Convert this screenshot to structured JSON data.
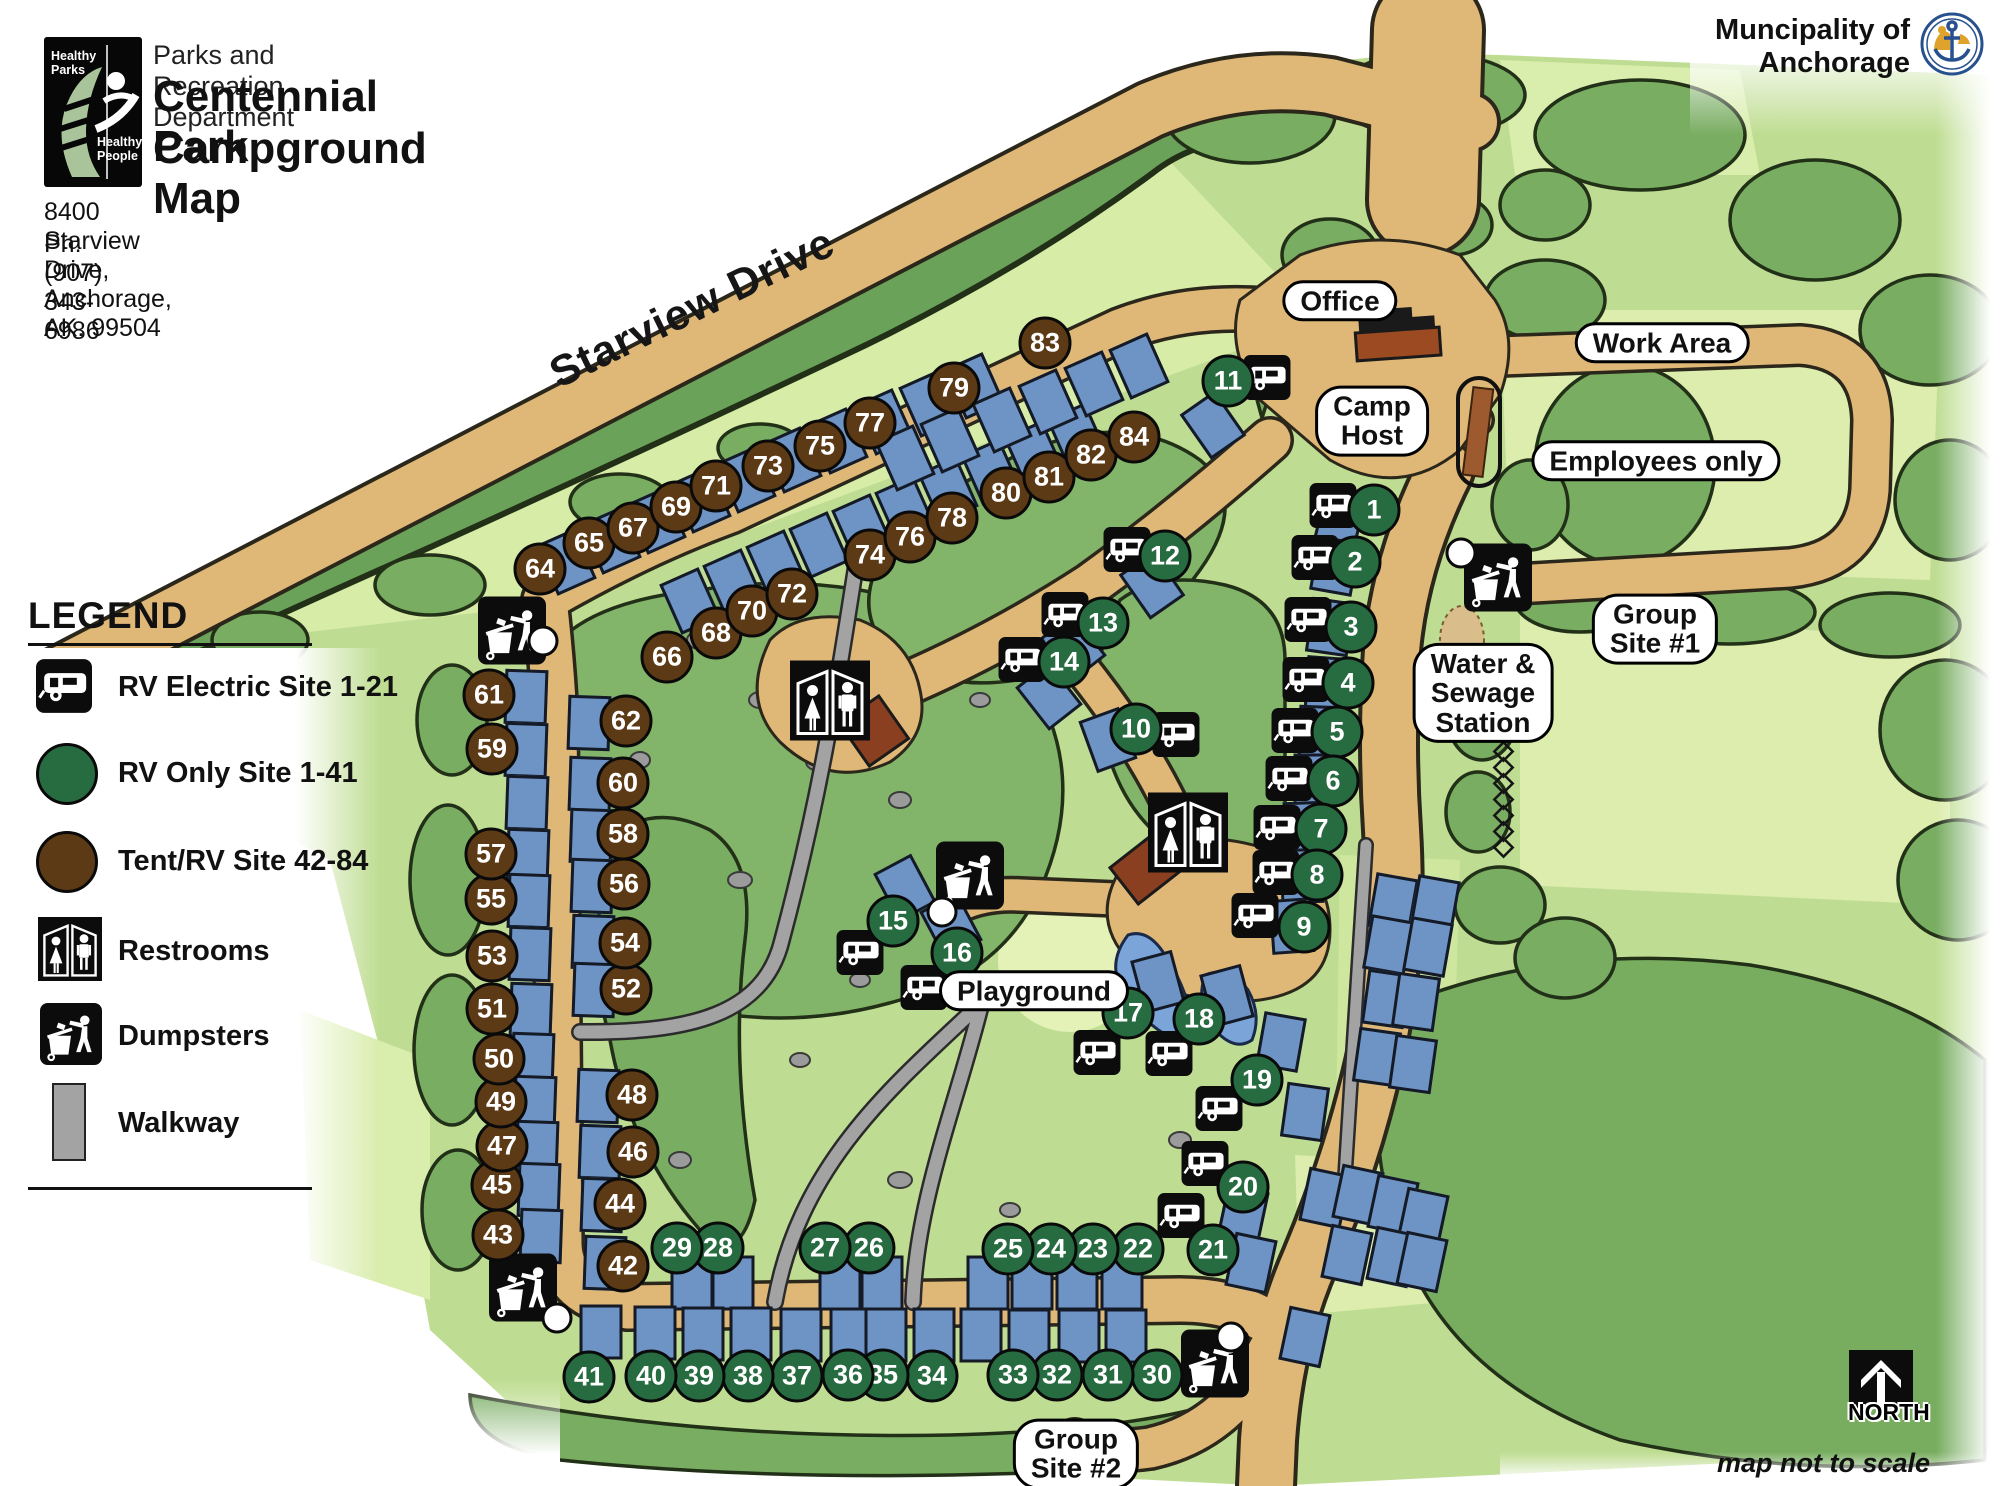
{
  "header": {
    "department": "Parks and Recreation Department",
    "title_line1": "Centennial Park",
    "title_line2": "Campground Map",
    "address": "8400 Starview Drive, Anchorage, AK. 99504",
    "phone": "Ph: (907) 343-6986",
    "logo": {
      "top_text": "Healthy\nParks",
      "bottom_text": "Healthy\nPeople"
    }
  },
  "municipality": {
    "line1": "Muncipality of",
    "line2": "Anchorage"
  },
  "legend": {
    "title": "LEGEND",
    "items": [
      {
        "icon": "rv-electric-icon",
        "label": "RV Electric Site 1-21"
      },
      {
        "icon": "rv-only-circle",
        "label": "RV Only Site 1-41",
        "color": "#276b41"
      },
      {
        "icon": "tent-rv-circle",
        "label": "Tent/RV Site 42-84",
        "color": "#5d3a16"
      },
      {
        "icon": "restrooms-icon",
        "label": "Restrooms"
      },
      {
        "icon": "dumpsters-icon",
        "label": "Dumpsters"
      },
      {
        "icon": "walkway-swatch",
        "label": "Walkway",
        "color": "#a3a3a3"
      }
    ]
  },
  "map": {
    "road_label": "Starview Drive",
    "north_label": "NORTH",
    "scale_note": "map not to scale",
    "colors": {
      "road": "#dfb878",
      "walkway": "#a3a3a3",
      "pad": "#6e93c5",
      "site_rv_only": "#276b41",
      "site_tent_rv": "#5d3a16",
      "tree": "#79ad62",
      "lawn": "#bfdd92"
    },
    "labels": [
      {
        "id": "office",
        "lines": [
          "Office"
        ],
        "x": 1340,
        "y": 301
      },
      {
        "id": "work-area",
        "lines": [
          "Work Area"
        ],
        "x": 1662,
        "y": 343
      },
      {
        "id": "camp-host",
        "lines": [
          "Camp",
          "Host"
        ],
        "x": 1372,
        "y": 421
      },
      {
        "id": "employees-only",
        "lines": [
          "Employees only"
        ],
        "x": 1656,
        "y": 461
      },
      {
        "id": "group-site-1",
        "lines": [
          "Group",
          "Site #1"
        ],
        "x": 1655,
        "y": 629
      },
      {
        "id": "water-sewage-station",
        "lines": [
          "Water &",
          "Sewage",
          "Station"
        ],
        "x": 1483,
        "y": 693
      },
      {
        "id": "playground",
        "lines": [
          "Playground"
        ],
        "x": 1034,
        "y": 991
      },
      {
        "id": "group-site-2",
        "lines": [
          "Group",
          "Site #2"
        ],
        "x": 1076,
        "y": 1454
      }
    ],
    "sites": [
      {
        "n": 1,
        "x": 1374,
        "y": 510
      },
      {
        "n": 2,
        "x": 1355,
        "y": 562
      },
      {
        "n": 3,
        "x": 1351,
        "y": 627
      },
      {
        "n": 4,
        "x": 1348,
        "y": 683
      },
      {
        "n": 5,
        "x": 1337,
        "y": 732
      },
      {
        "n": 6,
        "x": 1333,
        "y": 781
      },
      {
        "n": 7,
        "x": 1321,
        "y": 829
      },
      {
        "n": 8,
        "x": 1317,
        "y": 875
      },
      {
        "n": 9,
        "x": 1304,
        "y": 927
      },
      {
        "n": 10,
        "x": 1136,
        "y": 729
      },
      {
        "n": 11,
        "x": 1228,
        "y": 381
      },
      {
        "n": 12,
        "x": 1165,
        "y": 556
      },
      {
        "n": 13,
        "x": 1103,
        "y": 623
      },
      {
        "n": 14,
        "x": 1064,
        "y": 662
      },
      {
        "n": 15,
        "x": 893,
        "y": 921
      },
      {
        "n": 16,
        "x": 957,
        "y": 953
      },
      {
        "n": 17,
        "x": 1128,
        "y": 1013
      },
      {
        "n": 18,
        "x": 1199,
        "y": 1019
      },
      {
        "n": 19,
        "x": 1257,
        "y": 1080
      },
      {
        "n": 20,
        "x": 1243,
        "y": 1187
      },
      {
        "n": 21,
        "x": 1213,
        "y": 1250
      },
      {
        "n": 22,
        "x": 1138,
        "y": 1249
      },
      {
        "n": 23,
        "x": 1093,
        "y": 1249
      },
      {
        "n": 24,
        "x": 1051,
        "y": 1249
      },
      {
        "n": 25,
        "x": 1008,
        "y": 1249
      },
      {
        "n": 26,
        "x": 869,
        "y": 1248
      },
      {
        "n": 27,
        "x": 825,
        "y": 1248
      },
      {
        "n": 28,
        "x": 718,
        "y": 1248
      },
      {
        "n": 29,
        "x": 677,
        "y": 1248
      },
      {
        "n": 30,
        "x": 1157,
        "y": 1375
      },
      {
        "n": 31,
        "x": 1108,
        "y": 1375
      },
      {
        "n": 32,
        "x": 1057,
        "y": 1375
      },
      {
        "n": 33,
        "x": 1013,
        "y": 1375
      },
      {
        "n": 34,
        "x": 932,
        "y": 1376
      },
      {
        "n": 35,
        "x": 883,
        "y": 1375
      },
      {
        "n": 36,
        "x": 848,
        "y": 1375
      },
      {
        "n": 37,
        "x": 797,
        "y": 1376
      },
      {
        "n": 38,
        "x": 748,
        "y": 1376
      },
      {
        "n": 39,
        "x": 699,
        "y": 1376
      },
      {
        "n": 40,
        "x": 651,
        "y": 1376
      },
      {
        "n": 41,
        "x": 589,
        "y": 1377
      },
      {
        "n": 42,
        "x": 623,
        "y": 1266
      },
      {
        "n": 43,
        "x": 498,
        "y": 1235
      },
      {
        "n": 44,
        "x": 620,
        "y": 1204
      },
      {
        "n": 45,
        "x": 497,
        "y": 1185
      },
      {
        "n": 46,
        "x": 633,
        "y": 1152
      },
      {
        "n": 47,
        "x": 502,
        "y": 1146
      },
      {
        "n": 48,
        "x": 632,
        "y": 1095
      },
      {
        "n": 49,
        "x": 501,
        "y": 1102
      },
      {
        "n": 50,
        "x": 499,
        "y": 1059
      },
      {
        "n": 51,
        "x": 492,
        "y": 1009
      },
      {
        "n": 52,
        "x": 626,
        "y": 989
      },
      {
        "n": 53,
        "x": 492,
        "y": 956
      },
      {
        "n": 54,
        "x": 625,
        "y": 943
      },
      {
        "n": 55,
        "x": 491,
        "y": 899
      },
      {
        "n": 56,
        "x": 624,
        "y": 884
      },
      {
        "n": 57,
        "x": 491,
        "y": 854
      },
      {
        "n": 58,
        "x": 623,
        "y": 834
      },
      {
        "n": 59,
        "x": 492,
        "y": 749
      },
      {
        "n": 60,
        "x": 623,
        "y": 783
      },
      {
        "n": 61,
        "x": 489,
        "y": 695
      },
      {
        "n": 62,
        "x": 626,
        "y": 721
      },
      {
        "n": 64,
        "x": 540,
        "y": 569
      },
      {
        "n": 65,
        "x": 589,
        "y": 543
      },
      {
        "n": 66,
        "x": 667,
        "y": 657
      },
      {
        "n": 67,
        "x": 633,
        "y": 528
      },
      {
        "n": 68,
        "x": 716,
        "y": 633
      },
      {
        "n": 69,
        "x": 676,
        "y": 507
      },
      {
        "n": 70,
        "x": 752,
        "y": 611
      },
      {
        "n": 71,
        "x": 716,
        "y": 486
      },
      {
        "n": 72,
        "x": 792,
        "y": 594
      },
      {
        "n": 73,
        "x": 768,
        "y": 466
      },
      {
        "n": 74,
        "x": 870,
        "y": 555
      },
      {
        "n": 75,
        "x": 820,
        "y": 446
      },
      {
        "n": 76,
        "x": 910,
        "y": 537
      },
      {
        "n": 77,
        "x": 870,
        "y": 423
      },
      {
        "n": 78,
        "x": 952,
        "y": 518
      },
      {
        "n": 79,
        "x": 954,
        "y": 388
      },
      {
        "n": 80,
        "x": 1006,
        "y": 493
      },
      {
        "n": 81,
        "x": 1049,
        "y": 477
      },
      {
        "n": 82,
        "x": 1091,
        "y": 455
      },
      {
        "n": 83,
        "x": 1045,
        "y": 343
      },
      {
        "n": 84,
        "x": 1134,
        "y": 437
      }
    ],
    "rv_icons": [
      [
        1333,
        508
      ],
      [
        1315,
        560
      ],
      [
        1308,
        622
      ],
      [
        1306,
        682
      ],
      [
        1295,
        733
      ],
      [
        1289,
        781
      ],
      [
        1277,
        830
      ],
      [
        1276,
        875
      ],
      [
        1255,
        918
      ],
      [
        1176,
        737
      ],
      [
        1267,
        380
      ],
      [
        1127,
        552
      ],
      [
        1065,
        617
      ],
      [
        1022,
        662
      ],
      [
        860,
        955
      ],
      [
        924,
        990
      ],
      [
        1097,
        1055
      ],
      [
        1169,
        1056
      ],
      [
        1219,
        1111
      ],
      [
        1205,
        1166
      ],
      [
        1181,
        1218
      ]
    ],
    "restrooms": [
      [
        830,
        703
      ],
      [
        1188,
        835
      ]
    ],
    "dumpsters": [
      [
        512,
        633
      ],
      [
        970,
        878
      ],
      [
        523,
        1290
      ],
      [
        1215,
        1366
      ],
      [
        1498,
        580
      ]
    ],
    "dots": [
      [
        543,
        641
      ],
      [
        942,
        912
      ],
      [
        557,
        1318
      ],
      [
        1231,
        1337
      ],
      [
        1461,
        553
      ]
    ],
    "pads": [
      [
        566,
        562,
        -24
      ],
      [
        611,
        541,
        -24
      ],
      [
        656,
        521,
        -24
      ],
      [
        701,
        500,
        -24
      ],
      [
        746,
        480,
        -24
      ],
      [
        792,
        460,
        -24
      ],
      [
        838,
        441,
        -24
      ],
      [
        884,
        422,
        -24
      ],
      [
        929,
        404,
        -24
      ],
      [
        974,
        386,
        -24
      ],
      [
        690,
        601,
        -24
      ],
      [
        733,
        582,
        -24
      ],
      [
        776,
        563,
        -24
      ],
      [
        819,
        545,
        -24
      ],
      [
        862,
        527,
        -24
      ],
      [
        905,
        509,
        -24
      ],
      [
        948,
        490,
        -24
      ],
      [
        991,
        472,
        -24
      ],
      [
        1034,
        454,
        -24
      ],
      [
        1077,
        436,
        -24
      ],
      [
        1002,
        420,
        -24
      ],
      [
        1048,
        402,
        -24
      ],
      [
        1094,
        384,
        -24
      ],
      [
        1139,
        366,
        -24
      ],
      [
        905,
        458,
        -24
      ],
      [
        950,
        440,
        -24
      ],
      [
        526,
        697,
        2
      ],
      [
        526,
        750,
        2
      ],
      [
        527,
        803,
        2
      ],
      [
        528,
        856,
        2
      ],
      [
        529,
        901,
        2
      ],
      [
        530,
        954,
        2
      ],
      [
        531,
        1010,
        2
      ],
      [
        533,
        1060,
        2
      ],
      [
        535,
        1103,
        2
      ],
      [
        537,
        1148,
        2
      ],
      [
        539,
        1190,
        2
      ],
      [
        541,
        1236,
        2
      ],
      [
        589,
        723,
        2
      ],
      [
        590,
        784,
        2
      ],
      [
        591,
        836,
        2
      ],
      [
        592,
        886,
        2
      ],
      [
        593,
        942,
        2
      ],
      [
        594,
        990,
        2
      ],
      [
        598,
        1096,
        2
      ],
      [
        600,
        1152,
        2
      ],
      [
        602,
        1205,
        2
      ],
      [
        605,
        1263,
        2
      ],
      [
        692,
        1283,
        0
      ],
      [
        733,
        1283,
        0
      ],
      [
        840,
        1283,
        0
      ],
      [
        882,
        1283,
        0
      ],
      [
        988,
        1283,
        0
      ],
      [
        1032,
        1283,
        0
      ],
      [
        1077,
        1283,
        0
      ],
      [
        1122,
        1283,
        0
      ],
      [
        601,
        1332,
        0
      ],
      [
        655,
        1333,
        0
      ],
      [
        703,
        1334,
        0
      ],
      [
        751,
        1334,
        0
      ],
      [
        801,
        1335,
        0
      ],
      [
        851,
        1335,
        0
      ],
      [
        886,
        1335,
        0
      ],
      [
        934,
        1335,
        0
      ],
      [
        981,
        1335,
        0
      ],
      [
        1029,
        1336,
        0
      ],
      [
        1079,
        1336,
        0
      ],
      [
        1126,
        1336,
        0
      ],
      [
        1341,
        516,
        14
      ],
      [
        1335,
        566,
        10
      ],
      [
        1330,
        627,
        8
      ],
      [
        1327,
        684,
        4
      ],
      [
        1320,
        733,
        2
      ],
      [
        1315,
        781,
        0
      ],
      [
        1305,
        829,
        -2
      ],
      [
        1302,
        876,
        -2
      ],
      [
        1292,
        926,
        -4
      ],
      [
        1213,
        425,
        -35
      ],
      [
        1152,
        585,
        -35
      ],
      [
        1073,
        647,
        -38
      ],
      [
        1049,
        696,
        -38
      ],
      [
        1108,
        740,
        -20
      ],
      [
        905,
        888,
        -28
      ],
      [
        951,
        926,
        -28
      ],
      [
        1158,
        982,
        -15
      ],
      [
        1227,
        996,
        -15
      ],
      [
        1281,
        1042,
        10
      ],
      [
        1305,
        1112,
        8
      ],
      [
        1243,
        1215,
        12
      ],
      [
        1251,
        1263,
        12
      ],
      [
        1393,
        903,
        10
      ],
      [
        1435,
        905,
        10
      ],
      [
        1388,
        945,
        10
      ],
      [
        1428,
        947,
        10
      ],
      [
        1386,
        999,
        8
      ],
      [
        1416,
        1002,
        8
      ],
      [
        1377,
        1057,
        8
      ],
      [
        1413,
        1064,
        8
      ],
      [
        1325,
        1198,
        12
      ],
      [
        1358,
        1195,
        12
      ],
      [
        1393,
        1205,
        12
      ],
      [
        1423,
        1218,
        12
      ],
      [
        1347,
        1255,
        12
      ],
      [
        1392,
        1257,
        12
      ],
      [
        1422,
        1262,
        12
      ],
      [
        1305,
        1337,
        12
      ]
    ]
  }
}
